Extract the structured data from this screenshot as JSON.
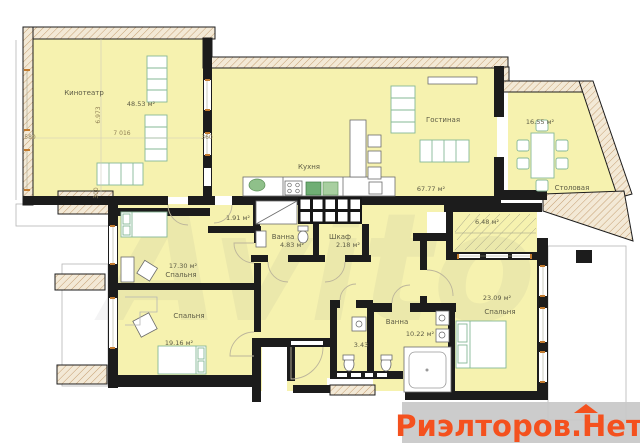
{
  "rooms": {
    "home_theater": {
      "label": "Кинотеатр",
      "area": "48.53 м²"
    },
    "kitchen": {
      "label": "Кухня"
    },
    "living_room": {
      "label": "Гостиная",
      "area": "67.77 м²"
    },
    "dining_room": {
      "label": "Столовая",
      "area": "16.55 м²"
    },
    "pantry": {
      "area": "1.91 м²"
    },
    "bathroom_small": {
      "label": "Ванна",
      "area": "4.83 м²"
    },
    "wardrobe": {
      "label": "Шкаф",
      "area": "2.18 м²"
    },
    "loggia": {
      "area": "6.48 м²"
    },
    "bedroom_1": {
      "label": "Спальня",
      "area": "17.30 м²"
    },
    "bedroom_2": {
      "label": "Спальня",
      "area": "19.16 м²"
    },
    "wc": {
      "area": "3.43"
    },
    "bathroom_big": {
      "label": "Ванна",
      "area": "10.22 м²"
    },
    "bedroom_3": {
      "label": "Спальня",
      "area": "23.09 м²"
    }
  },
  "dimensions": {
    "left_width": "580",
    "theater_height": "6.973",
    "theater_width": "7 016",
    "right_wall": "360",
    "bottom_height": "300"
  },
  "watermark": {
    "site": "Риэлторов.Нет",
    "faint": "Avito"
  },
  "colors": {
    "room_fill": "#f6f2af",
    "wall": "#1c1c1c",
    "brand_text": "#f4511e",
    "brand_band": "#c9c9c9",
    "window_tick": "#c27a2e"
  }
}
